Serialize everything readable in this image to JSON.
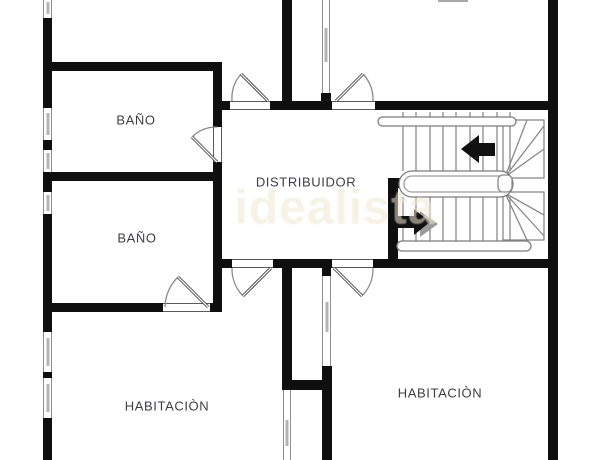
{
  "rooms": {
    "bathroom_top": {
      "label": "BAÑO"
    },
    "bathroom_middle": {
      "label": "BAÑO"
    },
    "hallway": {
      "label": "DISTRIBUIDOR"
    },
    "bedroom_left": {
      "label": "HABITACIÒN"
    },
    "bedroom_right": {
      "label": "HABITACIÒN"
    }
  },
  "watermark": {
    "text": "idealista"
  },
  "colors": {
    "wall": "#0f0f0f",
    "label_text": "#3d3d46",
    "stair_lines": "#8a8a8a",
    "watermark": "#efe8d2"
  }
}
